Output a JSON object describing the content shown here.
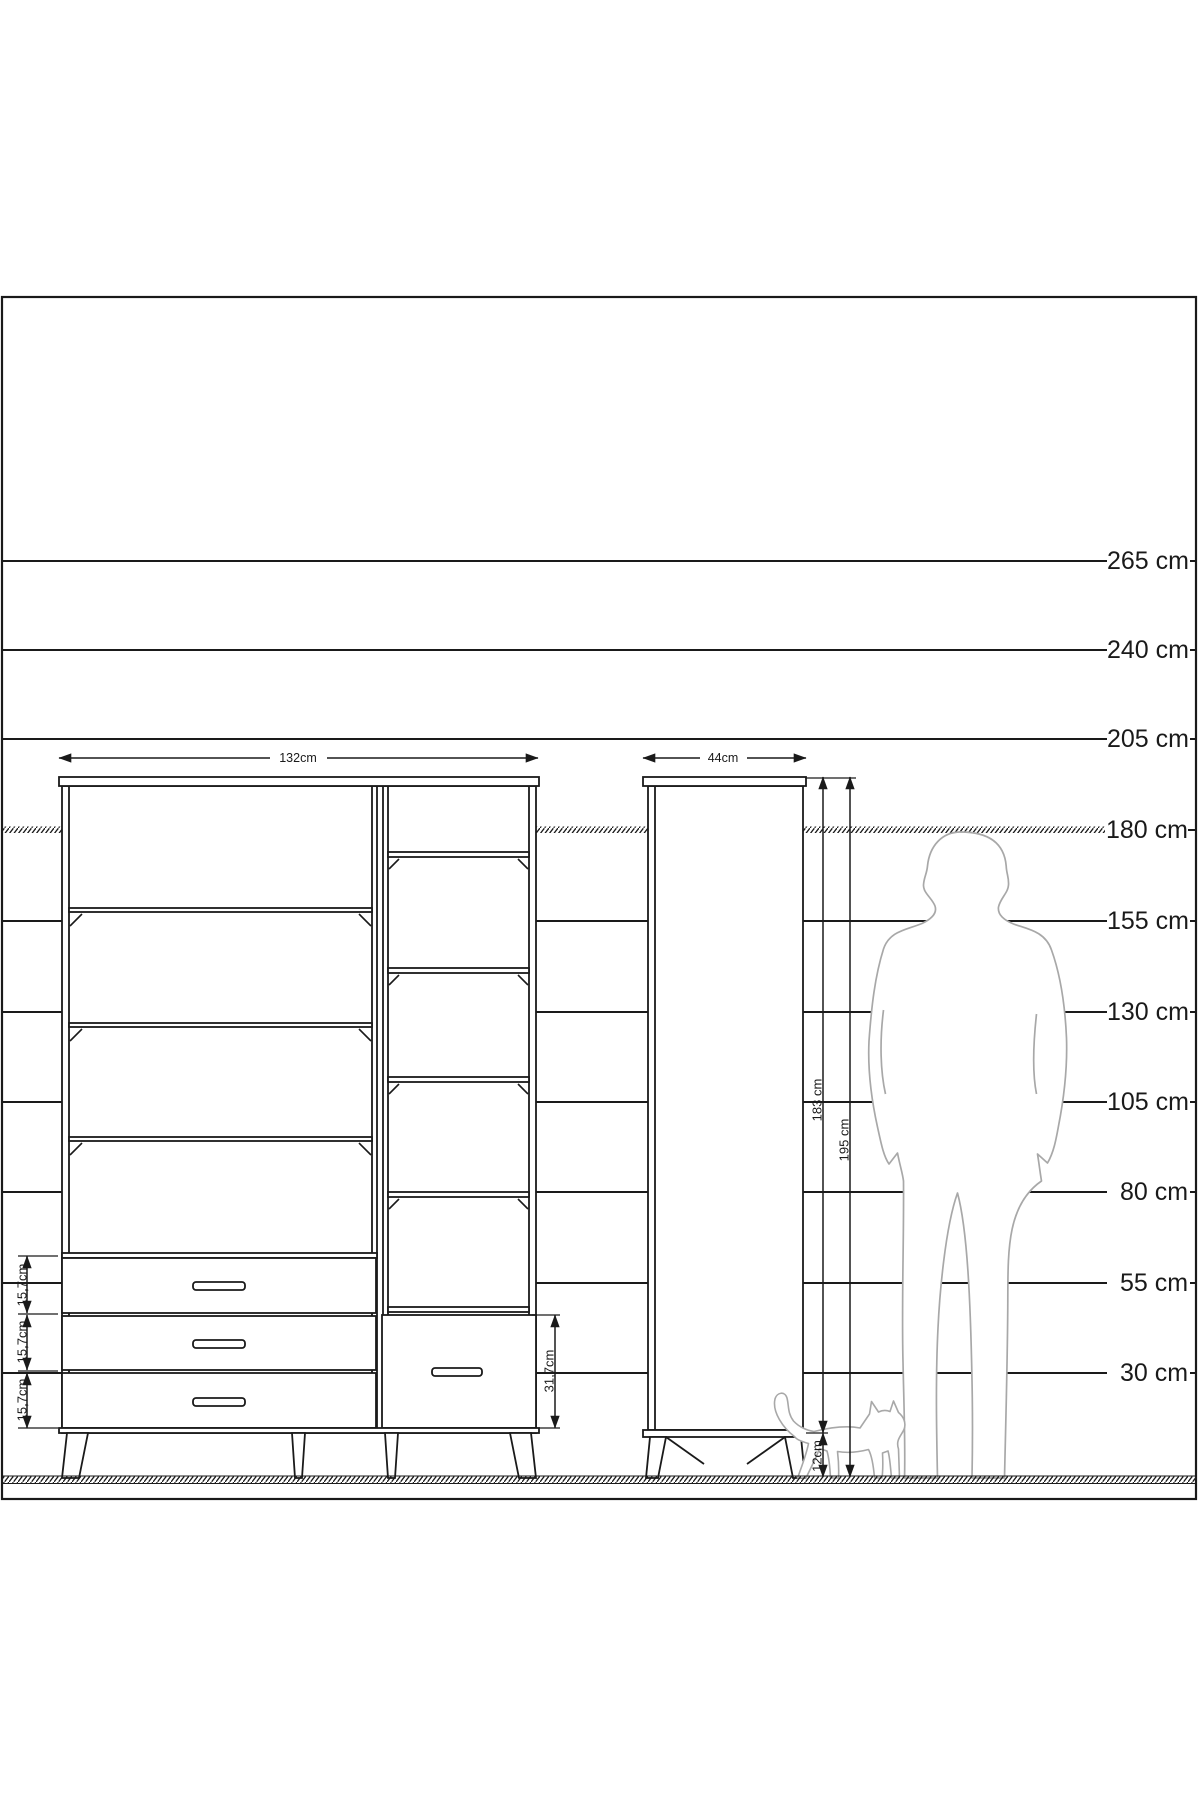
{
  "scale": {
    "labels": [
      "265 cm",
      "240 cm",
      "205 cm",
      "180 cm",
      "155 cm",
      "130 cm",
      "105 cm",
      "80 cm",
      "55 cm",
      "30 cm"
    ]
  },
  "dimensions": {
    "main_width": "132cm",
    "side_width": "44cm",
    "body_height": "183 cm",
    "total_height": "195 cm",
    "leg_height": "12cm",
    "drawer_height_1": "15,7cm",
    "drawer_height_2": "15,7cm",
    "drawer_height_3": "15,7cm",
    "right_drawer_height": "31,7cm"
  },
  "colors": {
    "line": "#1a1a1a",
    "figure_outline": "#a8a8a8",
    "background": "#ffffff"
  }
}
